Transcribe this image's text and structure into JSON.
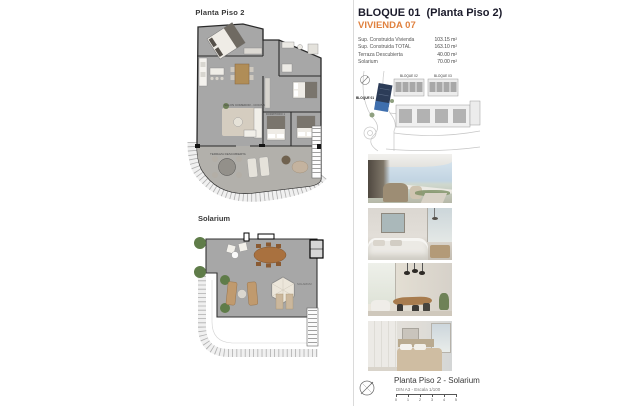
{
  "header": {
    "title": "BLOQUE 01  (Planta Piso 2)",
    "subtitle": "VIVIENDA 07"
  },
  "specs": [
    {
      "label": "Sup. Construida Vivienda",
      "value": "103.15 m²"
    },
    {
      "label": "Sup. Construida TOTAL",
      "value": "163.10 m²"
    },
    {
      "label": "Terraza Descubierta",
      "value": "40.00 m²"
    },
    {
      "label": "Solarium",
      "value": "70.00 m²"
    }
  ],
  "plans": {
    "floor_title": "Planta Piso 2",
    "solarium_title": "Solarium",
    "labels": {
      "living": "SALON COMEDOR - COCINA",
      "terrace": "TERRAZA DESCUBIERTA",
      "bedroom": "DORMITORIO 1",
      "solarium": "SOLARIUM"
    }
  },
  "site_plan": {
    "bloque01": "BLOQUE 01",
    "bloque02": "BLOQUE 02",
    "bloque03": "BLOQUE 03"
  },
  "photos": [
    {
      "name": "terrace-view"
    },
    {
      "name": "living-room"
    },
    {
      "name": "dining-room"
    },
    {
      "name": "bedroom"
    }
  ],
  "footer": {
    "caption": "Planta Piso 2 - Solarium",
    "scale_note": "DIN A3 - Escala 1/100",
    "scale_ticks": [
      "0",
      "1",
      "2",
      "3",
      "4",
      "5"
    ]
  },
  "colors": {
    "accent_orange": "#e0813f",
    "title_navy": "#1b1b2b",
    "plan_gray": "#a7a7a7",
    "highlight_navy": "#2c3c58",
    "highlight_blue": "#3f6fae"
  }
}
